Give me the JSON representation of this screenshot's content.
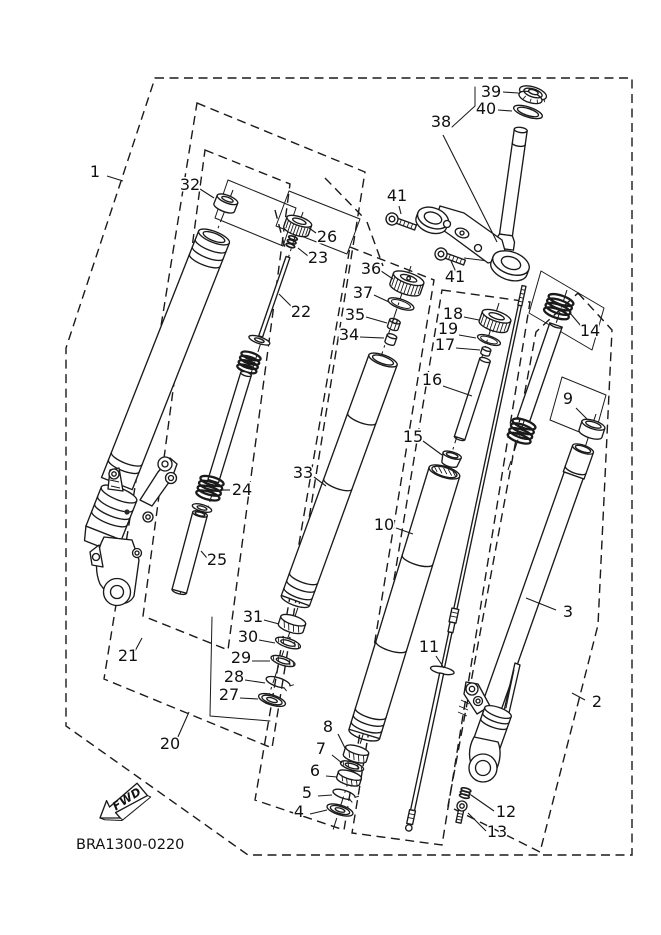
{
  "diagram": {
    "code": "BRA1300-0220",
    "fwd_label": "FWD",
    "background": "#ffffff",
    "line_color": "#1a1a1a"
  },
  "callouts": [
    {
      "n": "1",
      "x": 95,
      "y": 177,
      "l": [
        107,
        176,
        123,
        181
      ]
    },
    {
      "n": "32",
      "x": 190,
      "y": 190,
      "l": [
        200,
        189,
        214,
        198
      ]
    },
    {
      "n": "26",
      "x": 327,
      "y": 242,
      "l": [
        316,
        233,
        309,
        228
      ]
    },
    {
      "n": "23",
      "x": 318,
      "y": 263,
      "l": [
        308,
        256,
        298,
        248
      ]
    },
    {
      "n": "22",
      "x": 301,
      "y": 317,
      "l": [
        292,
        307,
        279,
        294
      ]
    },
    {
      "n": "24",
      "x": 242,
      "y": 495,
      "l": [
        230,
        490,
        220,
        490
      ]
    },
    {
      "n": "25",
      "x": 217,
      "y": 565,
      "l": [
        207,
        558,
        201,
        551
      ]
    },
    {
      "n": "21",
      "x": 128,
      "y": 661,
      "l": [
        135,
        651,
        142,
        638
      ]
    },
    {
      "n": "20",
      "x": 170,
      "y": 749,
      "l": [
        177,
        739,
        189,
        712
      ]
    },
    {
      "n": "33",
      "x": 303,
      "y": 478,
      "l": [
        314,
        477,
        326,
        486
      ]
    },
    {
      "n": "31",
      "x": 253,
      "y": 622,
      "l": [
        264,
        620,
        279,
        624
      ]
    },
    {
      "n": "30",
      "x": 248,
      "y": 642,
      "l": [
        259,
        640,
        275,
        643
      ]
    },
    {
      "n": "29",
      "x": 241,
      "y": 663,
      "l": [
        252,
        661,
        270,
        661
      ]
    },
    {
      "n": "28",
      "x": 234,
      "y": 682,
      "l": [
        245,
        680,
        265,
        683
      ]
    },
    {
      "n": "27",
      "x": 229,
      "y": 700,
      "l": [
        240,
        698,
        258,
        699
      ]
    },
    {
      "n": "36",
      "x": 371,
      "y": 274,
      "l": [
        381,
        271,
        393,
        279
      ]
    },
    {
      "n": "37",
      "x": 363,
      "y": 298,
      "l": [
        374,
        295,
        389,
        302
      ]
    },
    {
      "n": "35",
      "x": 355,
      "y": 320,
      "l": [
        366,
        317,
        387,
        323
      ]
    },
    {
      "n": "34",
      "x": 349,
      "y": 340,
      "l": [
        360,
        337,
        384,
        338
      ]
    },
    {
      "n": "38",
      "x": 441,
      "y": 127,
      "l": [
        443,
        135,
        497,
        242
      ]
    },
    {
      "n": "39",
      "x": 491,
      "y": 97,
      "l": [
        503,
        92,
        518,
        93
      ]
    },
    {
      "n": "40",
      "x": 486,
      "y": 114,
      "l": [
        498,
        110,
        512,
        111
      ]
    },
    {
      "n": "41",
      "x": 397,
      "y": 201,
      "l": [
        399,
        206,
        401,
        214
      ]
    },
    {
      "n": "41",
      "x": 455,
      "y": 282,
      "l": [
        456,
        272,
        451,
        261
      ]
    },
    {
      "n": "18",
      "x": 453,
      "y": 319,
      "l": [
        464,
        317,
        479,
        320
      ]
    },
    {
      "n": "19",
      "x": 448,
      "y": 334,
      "l": [
        459,
        335,
        476,
        338
      ]
    },
    {
      "n": "17",
      "x": 445,
      "y": 350,
      "l": [
        456,
        348,
        480,
        350
      ]
    },
    {
      "n": "16",
      "x": 432,
      "y": 385,
      "l": [
        443,
        386,
        472,
        396
      ]
    },
    {
      "n": "15",
      "x": 413,
      "y": 442,
      "l": [
        423,
        441,
        442,
        455
      ]
    },
    {
      "n": "10",
      "x": 384,
      "y": 530,
      "l": [
        396,
        528,
        413,
        534
      ]
    },
    {
      "n": "11",
      "x": 429,
      "y": 652,
      "l": [
        436,
        656,
        444,
        668
      ]
    },
    {
      "n": "14",
      "x": 590,
      "y": 336,
      "l": [
        581,
        326,
        570,
        313
      ]
    },
    {
      "n": "9",
      "x": 568,
      "y": 404,
      "l": [
        576,
        408,
        587,
        419
      ]
    },
    {
      "n": "3",
      "x": 568,
      "y": 617,
      "l": [
        556,
        610,
        526,
        598
      ]
    },
    {
      "n": "2",
      "x": 597,
      "y": 707,
      "l": [
        585,
        700,
        572,
        693
      ]
    },
    {
      "n": "12",
      "x": 506,
      "y": 817,
      "l": [
        494,
        811,
        471,
        795
      ]
    },
    {
      "n": "13",
      "x": 497,
      "y": 837,
      "l": [
        486,
        831,
        468,
        813
      ]
    },
    {
      "n": "8",
      "x": 328,
      "y": 732,
      "l": [
        338,
        734,
        345,
        748
      ]
    },
    {
      "n": "7",
      "x": 321,
      "y": 754,
      "l": [
        332,
        755,
        342,
        763
      ]
    },
    {
      "n": "6",
      "x": 315,
      "y": 776,
      "l": [
        326,
        776,
        337,
        777
      ]
    },
    {
      "n": "5",
      "x": 307,
      "y": 798,
      "l": [
        318,
        796,
        332,
        795
      ]
    },
    {
      "n": "4",
      "x": 299,
      "y": 817,
      "l": [
        310,
        814,
        327,
        810
      ]
    }
  ]
}
